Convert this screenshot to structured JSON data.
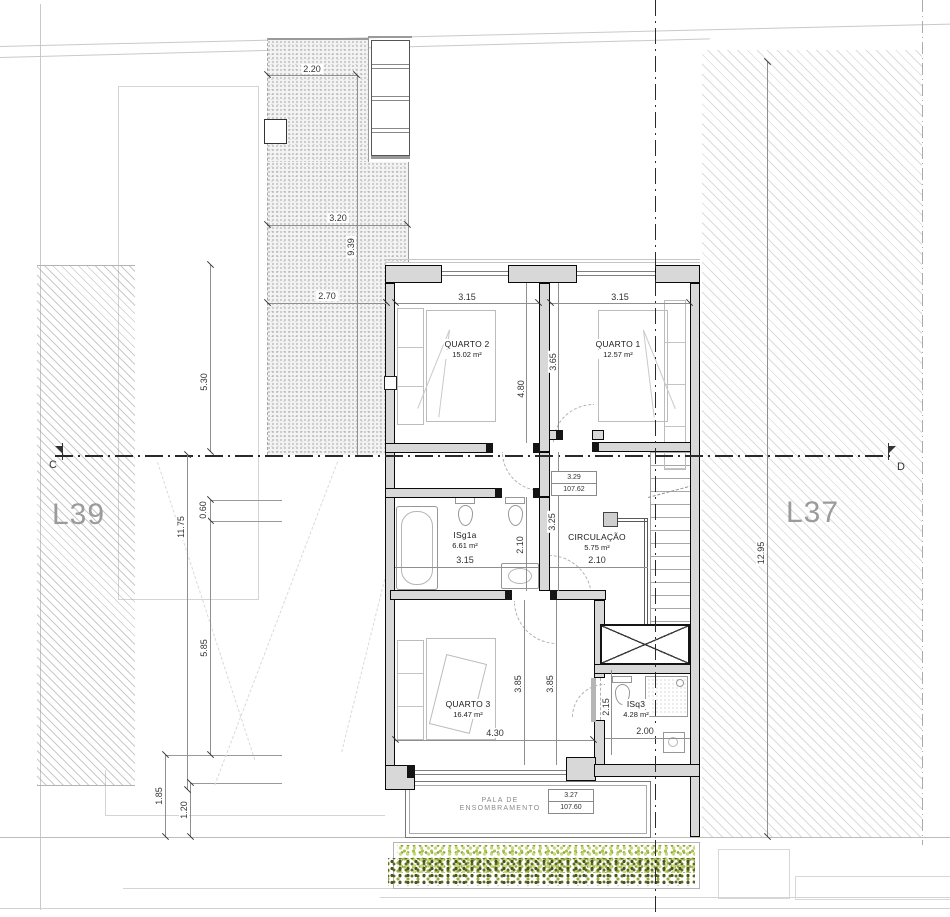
{
  "labels": {
    "lot_left": "L39",
    "lot_right": "L37",
    "section_left": "C",
    "section_right": "D",
    "canopy_line1": "PALA DE",
    "canopy_line2": "ENSOMBRAMENTO"
  },
  "rooms": [
    {
      "name": "QUARTO 2",
      "area": "15.02 m²"
    },
    {
      "name": "QUARTO 1",
      "area": "12.57 m²"
    },
    {
      "name": "ISg1a",
      "area": "6.61 m²"
    },
    {
      "name": "CIRCULAÇÃO",
      "area": "5.75 m²"
    },
    {
      "name": "QUARTO 3",
      "area": "16.47 m²"
    },
    {
      "name": "ISq3",
      "area": "4.28 m²"
    }
  ],
  "levels": [
    {
      "height": "3.29",
      "elevation": "107.62"
    },
    {
      "height": "3.27",
      "elevation": "107.60"
    }
  ],
  "dims": {
    "yard_top": "2.20",
    "yard_mid": "3.20",
    "yard_len": "9.39",
    "yard_low": "2.70",
    "left_a": "5.30",
    "left_b": "11.75",
    "left_c": "0.60",
    "left_d": "5.85",
    "left_e": "1.85",
    "left_f": "1.20",
    "right_a": "12.95",
    "q2_w": "3.15",
    "q2_d": "4.80",
    "q1_w": "3.15",
    "q1_d": "3.65",
    "isg_w": "3.15",
    "isg_d": "2.10",
    "hall_d": "3.25",
    "circ_w": "2.10",
    "q3_w": "4.30",
    "q3_d1": "3.85",
    "q3_d2": "3.85",
    "isq_w": "2.00",
    "isq_d": "2.15"
  }
}
